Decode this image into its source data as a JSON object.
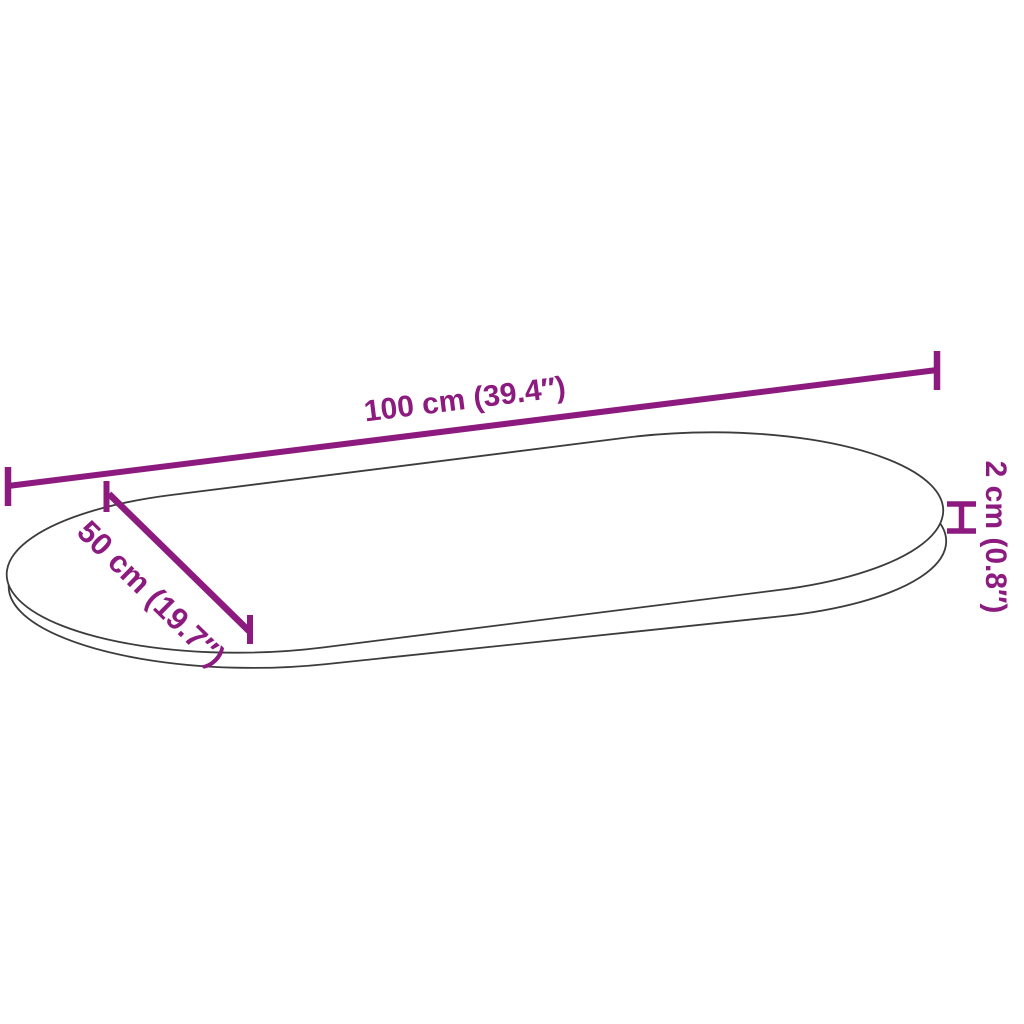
{
  "diagram": {
    "background_color": "#ffffff",
    "outline_color": "#3c3c3c",
    "accent_color": "#8C1A7F",
    "shape": "oval-table-top",
    "labels": {
      "length": "100 cm (39.4″)",
      "width": "50 cm (19.7″)",
      "thickness": "2 cm (0.8″)"
    }
  }
}
